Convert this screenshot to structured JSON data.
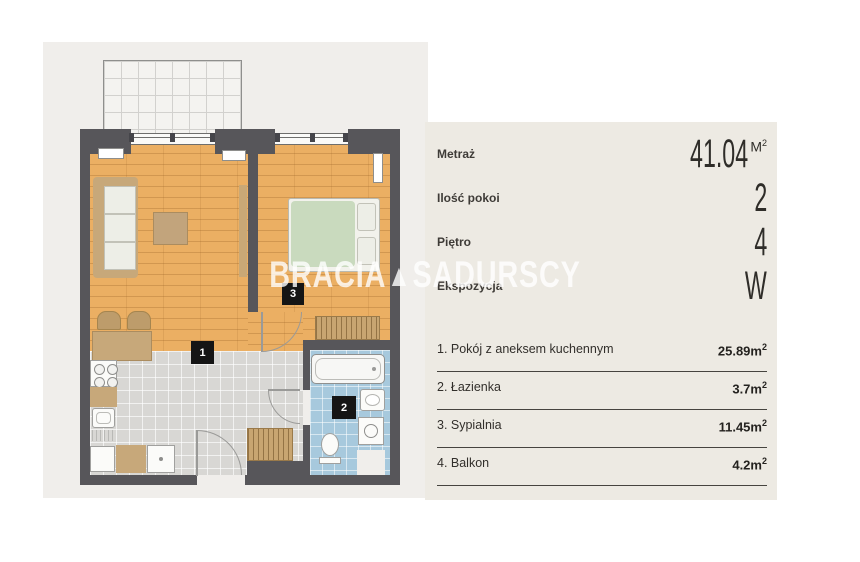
{
  "watermark": {
    "part1": "BRACIA",
    "triangle": "▲",
    "part2": "SADURSCY"
  },
  "panel": {
    "specs": [
      {
        "label": "Metraż",
        "value": "41.04",
        "unit_base": "M",
        "unit_sup": "2"
      },
      {
        "label": "Ilość pokoi",
        "value": "2"
      },
      {
        "label": "Piętro",
        "value": "4"
      },
      {
        "label": "Ekspozycja",
        "value": "W"
      }
    ],
    "rooms": [
      {
        "label": "1. Pokój z aneksem kuchennym",
        "area": "25.89",
        "unit_base": "m",
        "unit_sup": "2"
      },
      {
        "label": "2. Łazienka",
        "area": "3.7",
        "unit_base": "m",
        "unit_sup": "2"
      },
      {
        "label": "3. Sypialnia",
        "area": "11.45",
        "unit_base": "m",
        "unit_sup": "2"
      },
      {
        "label": "4. Balkon",
        "area": "4.2",
        "unit_base": "m",
        "unit_sup": "2"
      }
    ]
  },
  "plan": {
    "room_labels": [
      "1",
      "2",
      "3"
    ],
    "colors": {
      "wall": "#57565A",
      "wood_floor": "#EBAF63",
      "kitchen_tiles": "#D8D7D4",
      "bathroom_tiles": "#A7C9DD",
      "plan_background": "#F0EEEB",
      "panel_background": "#EDEAE3",
      "bed_duvet": "#C9DABE",
      "furniture_tan": "#C7A87A"
    }
  }
}
